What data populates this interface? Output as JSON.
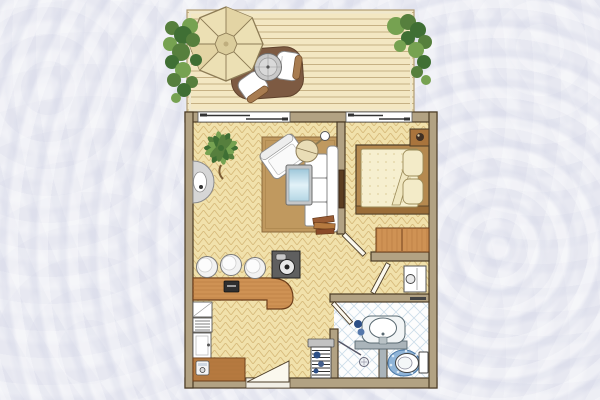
{
  "meta": {
    "kind": "hand-drawn apartment floor plan illustration",
    "width": 600,
    "height": 400,
    "visible_text": "none"
  },
  "palette": {
    "bg": "#e7e8f1",
    "outline": "#4a3b26",
    "wall": "#b2a283",
    "deck": "#f3e7c2",
    "deckLine": "#c6b184",
    "deckEdge": "#efe7cd",
    "parquet": "#f1e1ab",
    "parquetLine": "#d8bc7d",
    "rug": "#c0995f",
    "rugLine": "#8d6b3e",
    "wood": "#cf9254",
    "woodDark": "#6b3d1a",
    "woodLine": "#aa6f35",
    "woodDesk": "#b5793f",
    "bedFrame": "#b5894f",
    "bedRail": "#9a6d38",
    "mattress": "#f6efcf",
    "mattressLine": "#9c8c5a",
    "quiltDot": "#e0d3a2",
    "cream": "#ece0b4",
    "creamDark": "#8d7c56",
    "hub": "#dbcd9c",
    "panelShade": "#e3d4a4",
    "matBrown": "#7d5a42",
    "cushion": "#a87c50",
    "white": "#ffffff",
    "offWhite": "#fbf8ee",
    "grayLight": "#d6d6d6",
    "grayMid": "#8a8a8a",
    "grayDark": "#555555",
    "steel": "#aab4ba",
    "glass1": "#9ec7da",
    "glass2": "#e2f2f8",
    "glass3": "#b4d6e4",
    "tileLine": "#ccdde9",
    "bathFloor": "#fdfdfd",
    "fixLine": "#5a6a72",
    "blueMat": "#8fb4d8",
    "blueMatDark": "#4a79a8",
    "navy": "#2d4f86",
    "greenDark": "#3f6f34",
    "greenMid": "#567f3d",
    "greenLight": "#76a251",
    "trunk": "#7a5b33",
    "dark": "#333333",
    "sink": "#5f5f5f",
    "tv": "#5c3f22"
  },
  "diagram_contents": {
    "terrace": [
      "wood plank deck",
      "octagonal parasol",
      "round table",
      "two lounge chairs on brown mat",
      "ivy plant left corner",
      "ivy plant right corner"
    ],
    "living_room": [
      "herringbone parquet floor",
      "brown rug",
      "white sofa",
      "white armchair (rotated)",
      "glass coffee table",
      "arc floor lamp",
      "potted palm",
      "half-round console table",
      "wall-mounted tv panel",
      "magazine stack"
    ],
    "kitchenette": [
      "curved bar counter",
      "three white stools",
      "dark sink/cooktop unit",
      "counter appliance",
      "fridge",
      "vented appliance",
      "tall cabinet",
      "small desk",
      "telephone"
    ],
    "bedroom": [
      "double bed with two pillows and folded duvet",
      "nightstand with lamp",
      "wardrobe",
      "sliding glass door to terrace"
    ],
    "corridor": [
      "minibar cabinet",
      "swing door to bedroom",
      "swing door to corridor",
      "towel radiator with towels"
    ],
    "bathroom": [
      "diamond tile floor",
      "washbasin with vanity shelf",
      "navy towels",
      "toilet with blue mat",
      "shower area with floor drain",
      "shower door",
      "swing entry door"
    ],
    "entry": [
      "entrance door leaf in bottom wall opening"
    ]
  }
}
